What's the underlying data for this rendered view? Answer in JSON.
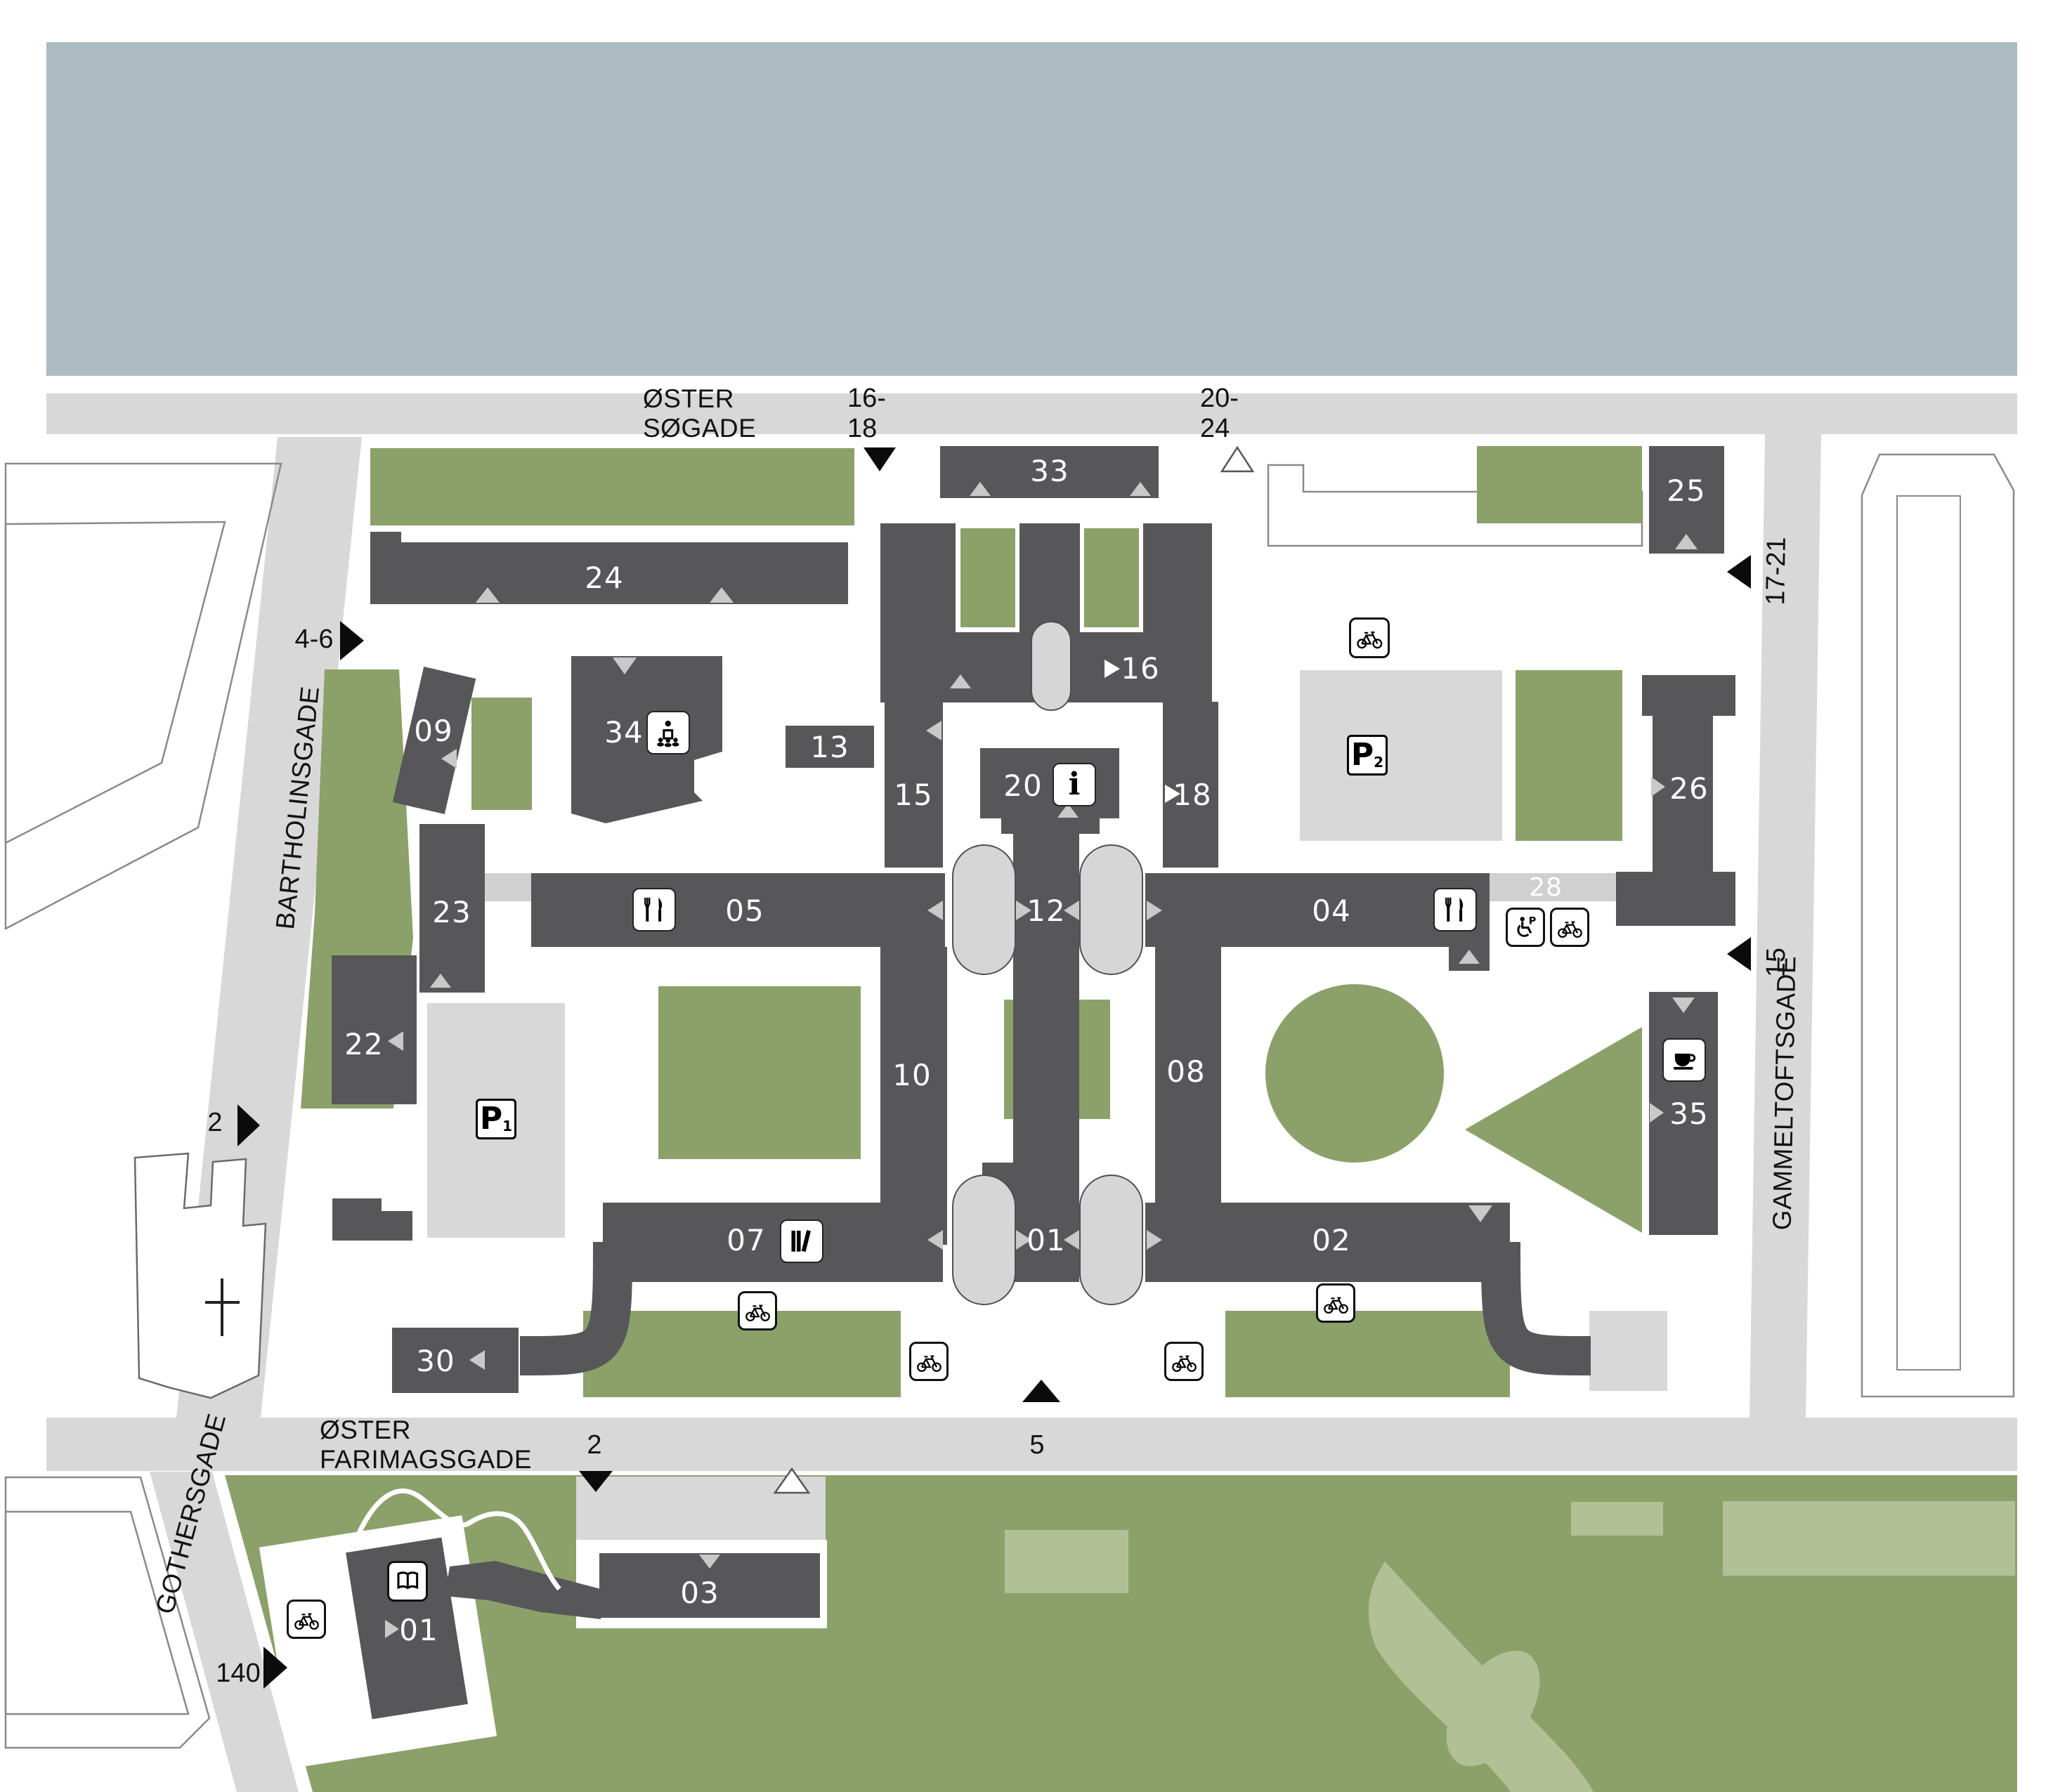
{
  "colors": {
    "water": "#adbcc3",
    "road": "#d8d8d8",
    "building": "#575659",
    "green": "#8ba169",
    "green_light": "#b2c096",
    "parking_lot": "#d8d8d8",
    "corridor": "#d0d0d0",
    "arch": "#d6d6d6",
    "entrance_gray": "#c9c9c9"
  },
  "streets": {
    "oster_sogade": {
      "name": "ØSTER SØGADE",
      "numbers": [
        "16-18",
        "20-24"
      ]
    },
    "bartholinsgade": {
      "name": "BARTHOLINSGADE",
      "numbers": [
        "4-6",
        "2"
      ]
    },
    "gothersgade": {
      "name": "GOTHERSGADE",
      "numbers": [
        "140"
      ]
    },
    "oster_farimagsgade": {
      "name": "ØSTER FARIMAGSGADE",
      "numbers": [
        "2",
        "5"
      ]
    },
    "gammeltoftsgade": {
      "name": "GAMMELTOFTSGADE",
      "numbers": [
        "17-21",
        "15"
      ]
    }
  },
  "buildings": {
    "b01": "01",
    "b01s": "01",
    "b02": "02",
    "b03": "03",
    "b04": "04",
    "b05": "05",
    "b07": "07",
    "b08": "08",
    "b09": "09",
    "b10": "10",
    "b12": "12",
    "b13": "13",
    "b15": "15",
    "b16": "16",
    "b18": "18",
    "b20": "20",
    "b22": "22",
    "b23": "23",
    "b24": "24",
    "b25": "25",
    "b26": "26",
    "b28": "28",
    "b30": "30",
    "b33": "33",
    "b34": "34",
    "b35": "35"
  },
  "parking": {
    "p1": {
      "label": "P",
      "sub": "1"
    },
    "p2": {
      "label": "P",
      "sub": "2"
    }
  },
  "legend_icons": [
    "bike-parking",
    "restaurant",
    "library",
    "lecture-hall",
    "information",
    "cafe",
    "disabled-parking",
    "reading-room"
  ]
}
